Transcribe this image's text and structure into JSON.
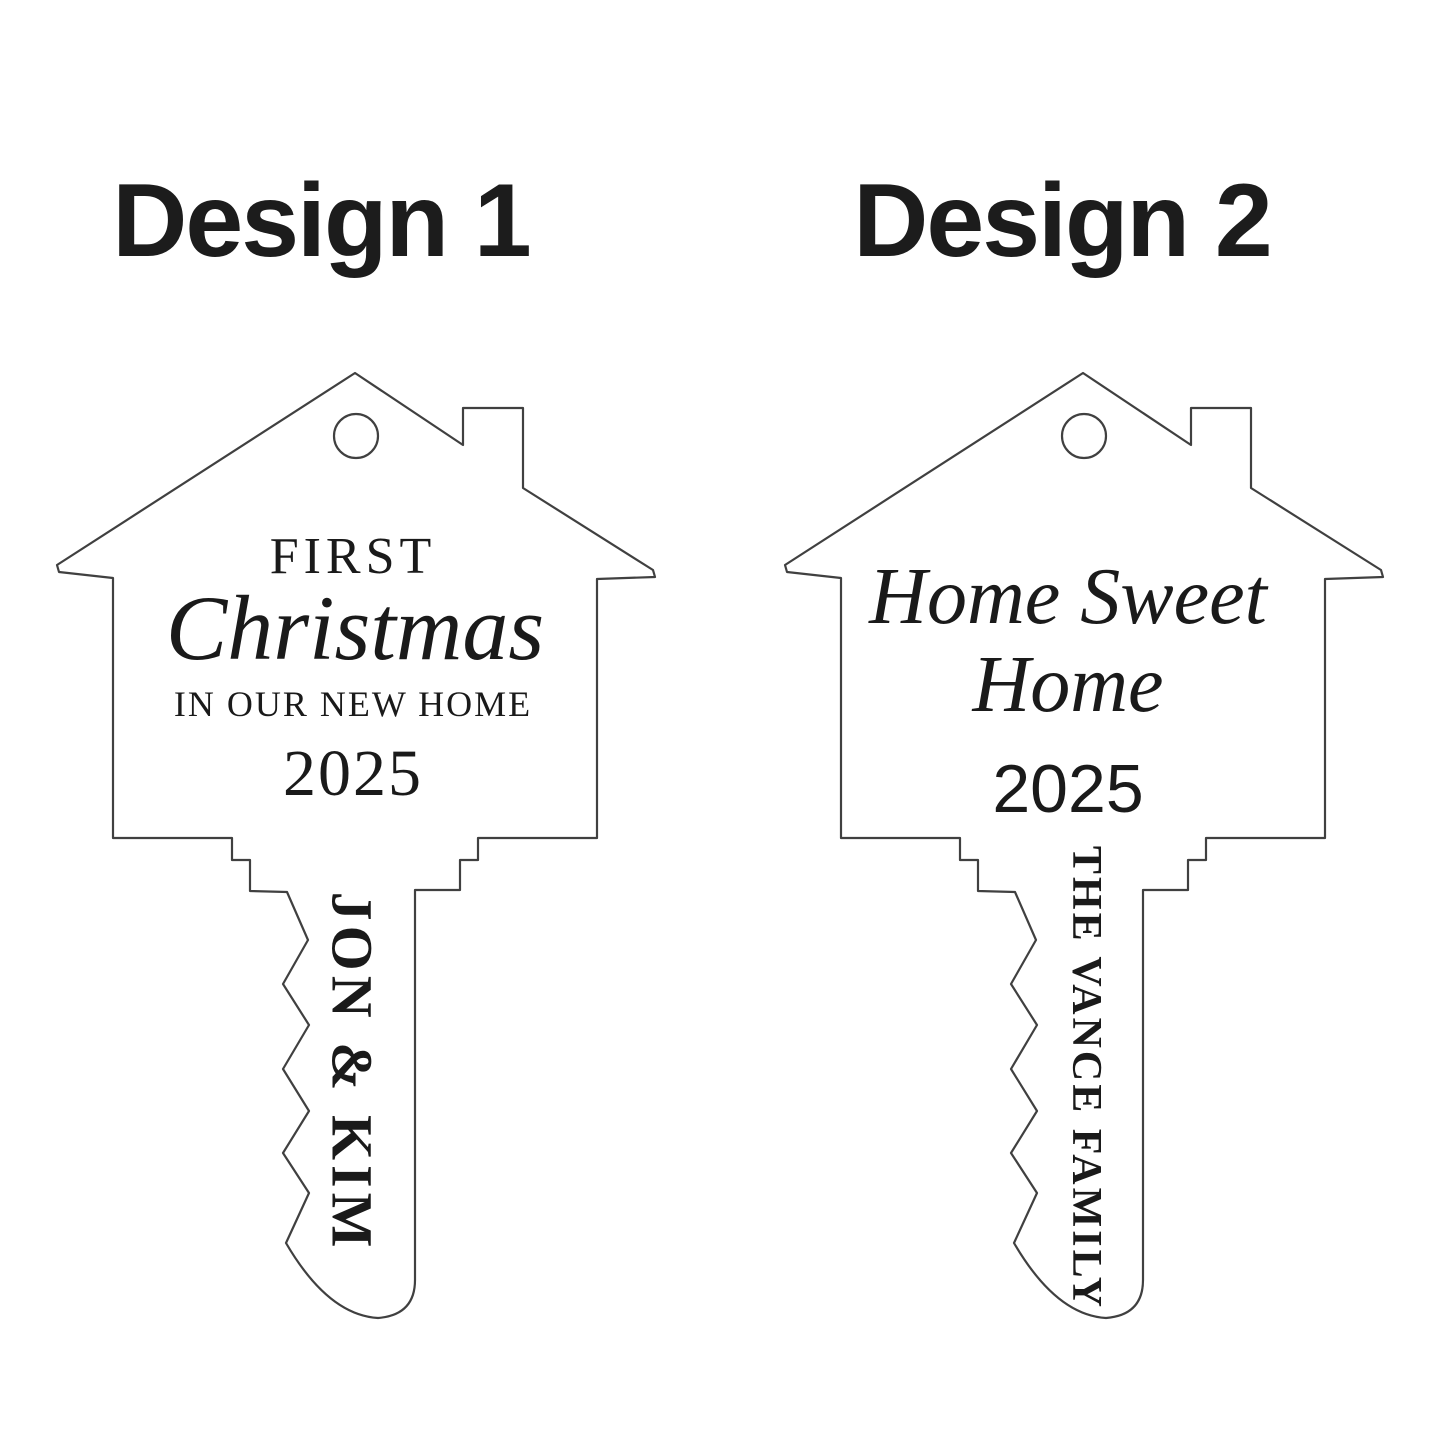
{
  "canvas": {
    "background": "#ffffff",
    "outline_color": "#404040",
    "text_color": "#1a1a1a"
  },
  "designs": [
    {
      "title": "Design 1",
      "house_lines": [
        "FIRST",
        "Christmas",
        "IN OUR NEW HOME"
      ],
      "year": "2025",
      "shaft_text": "JON & KIM"
    },
    {
      "title": "Design 2",
      "house_lines": [
        "Home Sweet",
        "Home"
      ],
      "year": "2025",
      "shaft_text": "THE VANCE FAMILY"
    }
  ]
}
